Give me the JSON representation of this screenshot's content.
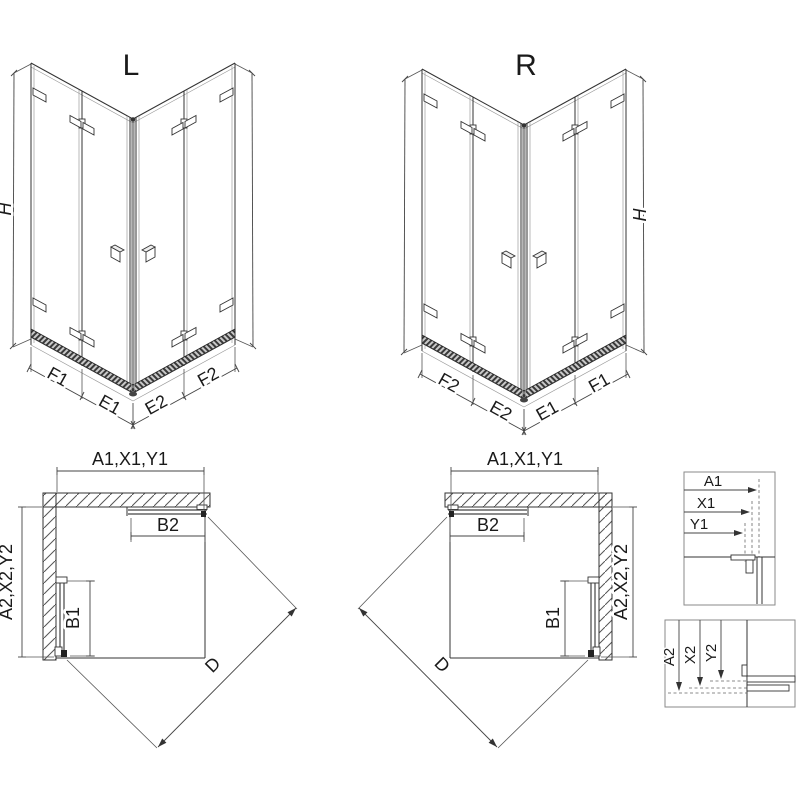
{
  "drawing": {
    "left_view": {
      "title": "L"
    },
    "right_view": {
      "title": "R"
    },
    "labels": {
      "height": "H",
      "f1": "F1",
      "e1": "E1",
      "e2": "E2",
      "f2": "F2",
      "width_group": "A1,X1,Y1",
      "depth_group": "A2,X2,Y2",
      "door_side": "B1",
      "door_top": "B2",
      "diagonal": "D",
      "a1": "A1",
      "x1": "X1",
      "y1": "Y1",
      "a2": "A2",
      "x2": "X2",
      "y2": "Y2"
    },
    "colors": {
      "line": "#333333",
      "background": "#ffffff"
    }
  }
}
